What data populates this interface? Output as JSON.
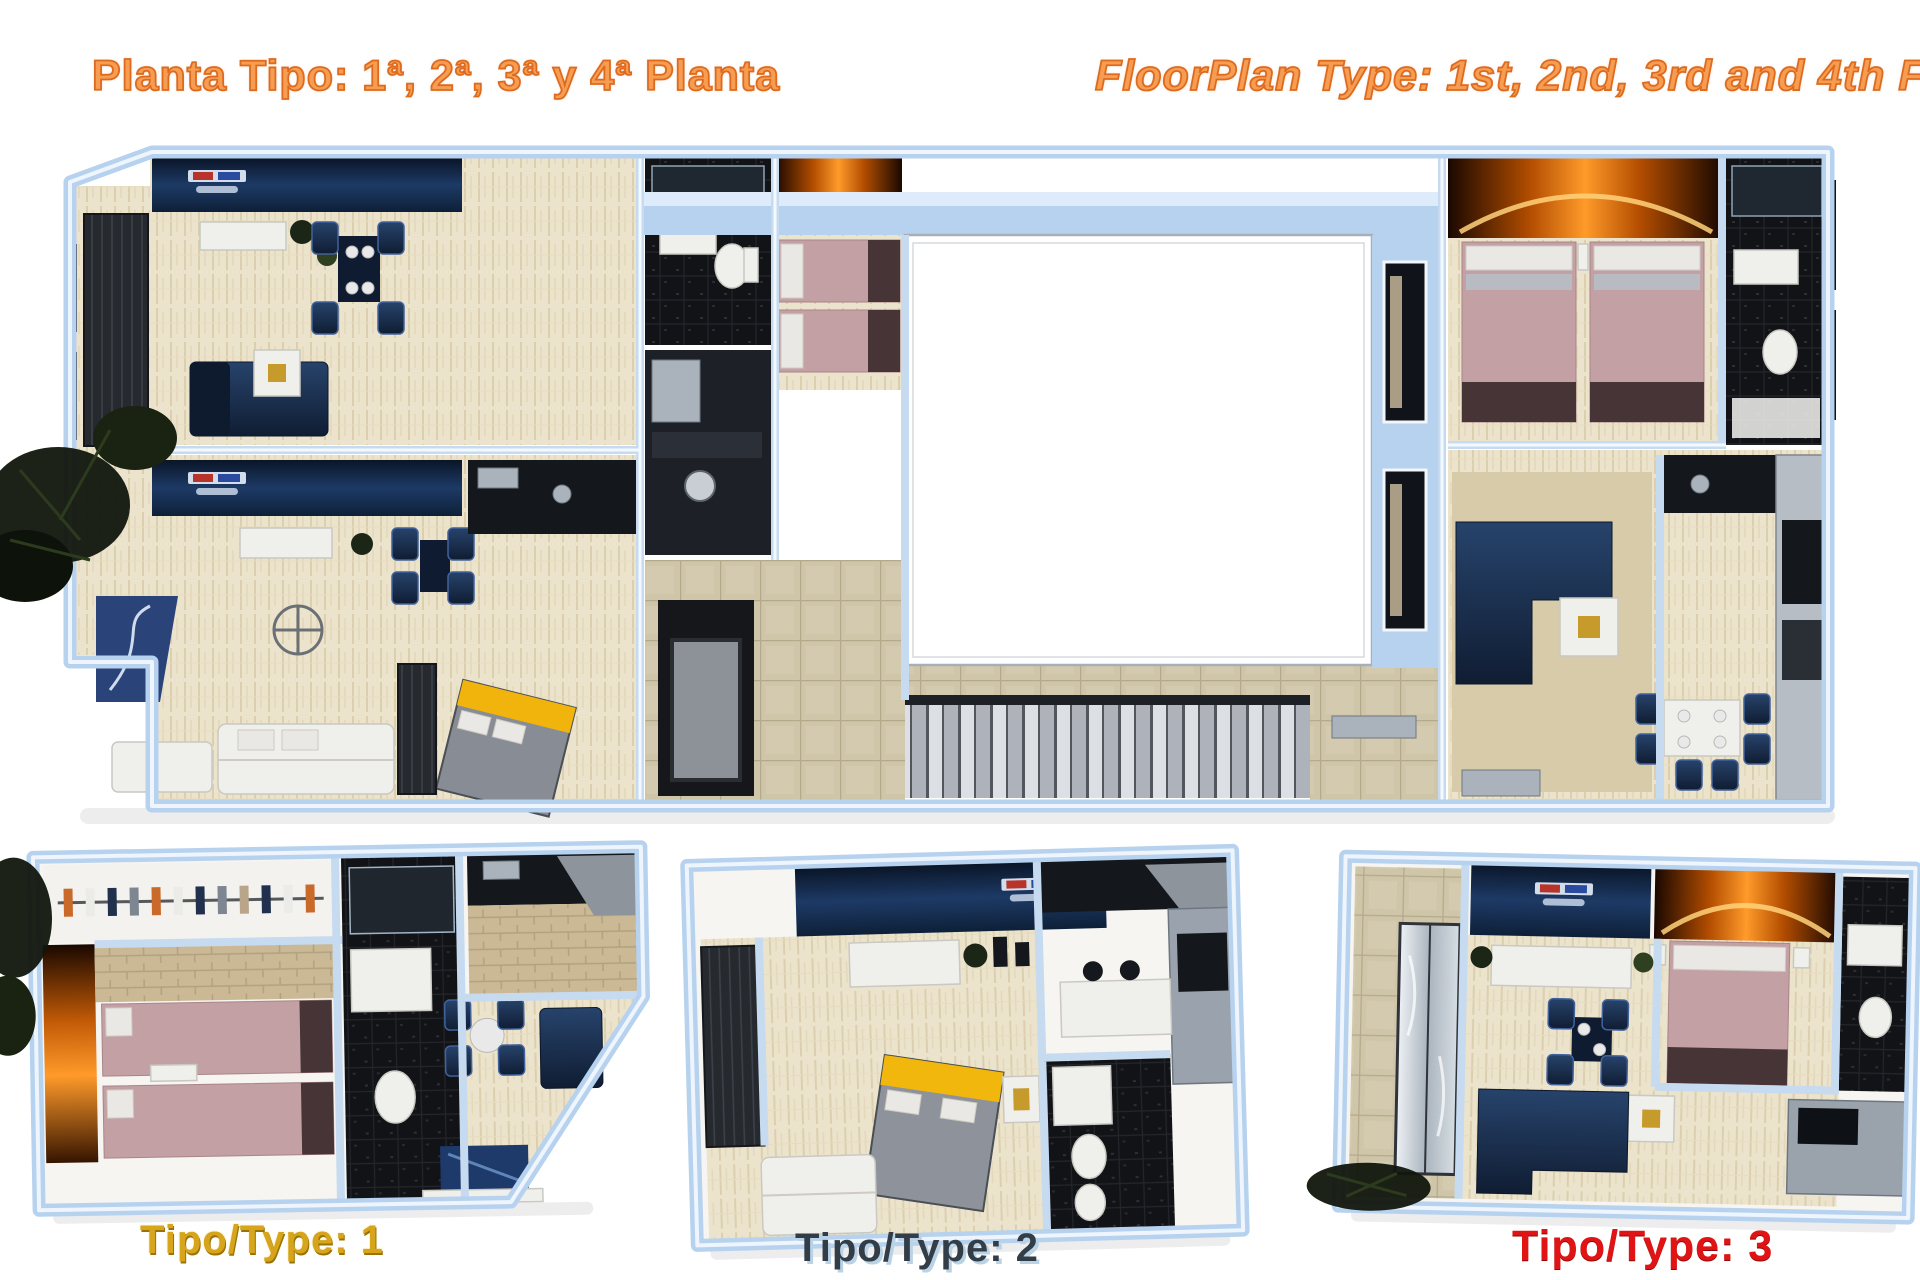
{
  "titles": {
    "spanish": "Planta Tipo: 1ª, 2ª, 3ª y 4ª Planta",
    "english": "FloorPlan Type: 1st, 2nd, 3rd and 4th Floor"
  },
  "labels": {
    "type1": "Tipo/Type: 1",
    "type2": "Tipo/Type: 2",
    "type3": "Tipo/Type: 3"
  },
  "colors": {
    "title_orange": "#f79d52",
    "title_outline": "#dd6b1f",
    "label_gold": "#d7a51b",
    "label_slate": "#333d47",
    "label_red": "#e01414",
    "wall_blue": "#b7d2ee",
    "floor_cream": "#ece3cc",
    "tile_tan": "#cfc5a9",
    "bathroom_black": "#111316",
    "furniture_navy": "#16263f",
    "bed_pink": "#c3a0a4",
    "fire_glow": "#ff9a2a",
    "bed_yellow": "#f0b40c"
  }
}
